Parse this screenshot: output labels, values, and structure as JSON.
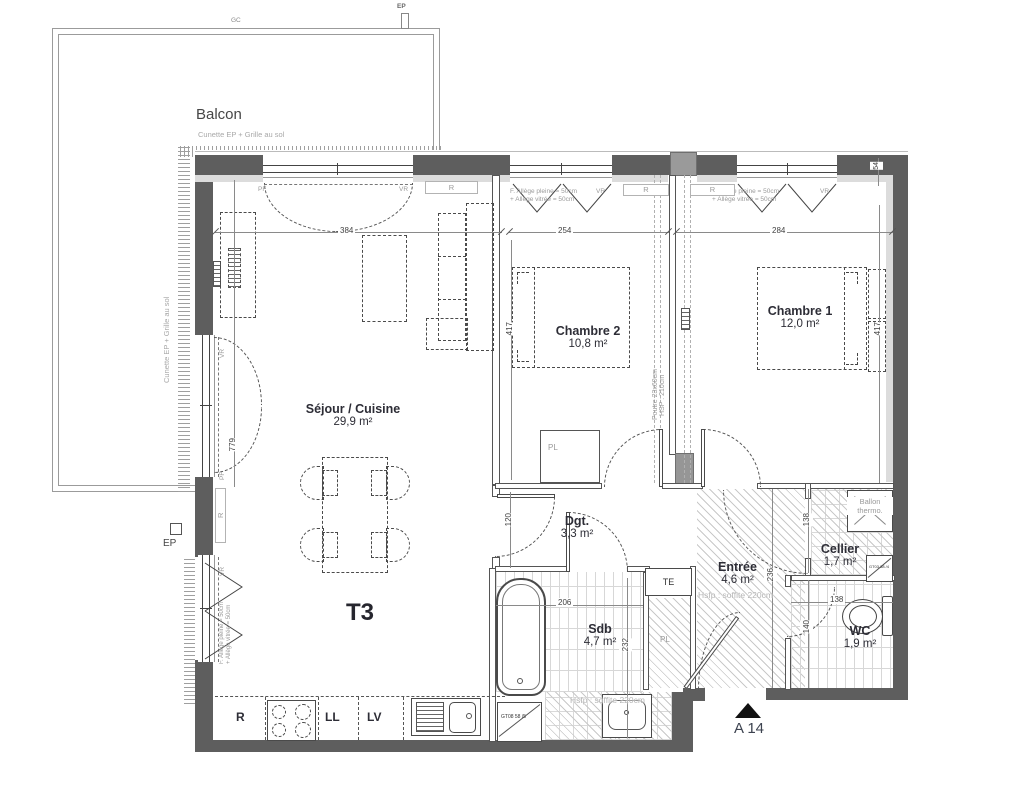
{
  "title": {
    "type": "T3",
    "unit": "A 14"
  },
  "balcony": {
    "name": "Balcon",
    "note": "Cunette EP + Grille au sol",
    "side_note": "Cunette EP + Grille au sol",
    "gc": "GC",
    "ep": "EP",
    "ep2": "EP"
  },
  "rooms": {
    "sejour": {
      "name": "Séjour / Cuisine",
      "area": "29,9 m²"
    },
    "chambre2": {
      "name": "Chambre 2",
      "area": "10,8 m²"
    },
    "chambre1": {
      "name": "Chambre 1",
      "area": "12,0 m²"
    },
    "dgt": {
      "name": "Dgt.",
      "area": "3,3 m²"
    },
    "sdb": {
      "name": "Sdb",
      "area": "4,7 m²"
    },
    "entree": {
      "name": "Entrée",
      "area": "4,6 m²"
    },
    "cellier": {
      "name": "Cellier",
      "area": "1,7 m²"
    },
    "wc": {
      "name": "WC",
      "area": "1,9 m²"
    }
  },
  "dims": {
    "living_w": "384",
    "ch2_w": "254",
    "ch1_w": "284",
    "offset": "54",
    "ch2_h": "417",
    "ch1_h": "417",
    "living_h": "779",
    "dgt_h": "120",
    "sdb_w": "206",
    "sdb_h": "232",
    "entree_h": "236",
    "cellier_h": "138",
    "wc_w": "138",
    "wc_h": "140"
  },
  "annotations": {
    "window_note_l1": "F. Allège pleine = 50cm",
    "window_note_l2": "+ Allège vitrée = 50cm",
    "hsfp": "Hsfp : soffite 220cm",
    "beam_l1": "Poutre 23x60cm",
    "beam_l2": "HSP : 210cm",
    "ballon_l1": "Ballon",
    "ballon_l2": "thermo.",
    "door_ref_sdb": "GT08 58 /5",
    "door_ref_wc": "GT03 38 /4"
  },
  "tags": {
    "pf": "PF",
    "vr": "VR",
    "r": "R",
    "te": "TE",
    "pl": "PL",
    "ll": "LL",
    "lv": "LV",
    "fridge": "R"
  },
  "colors": {
    "wall": "#5e5e5e",
    "wall_lining": "#dcdcdc",
    "label_dark": "#2d2d36",
    "annotation_gray": "#a3a3a3"
  }
}
